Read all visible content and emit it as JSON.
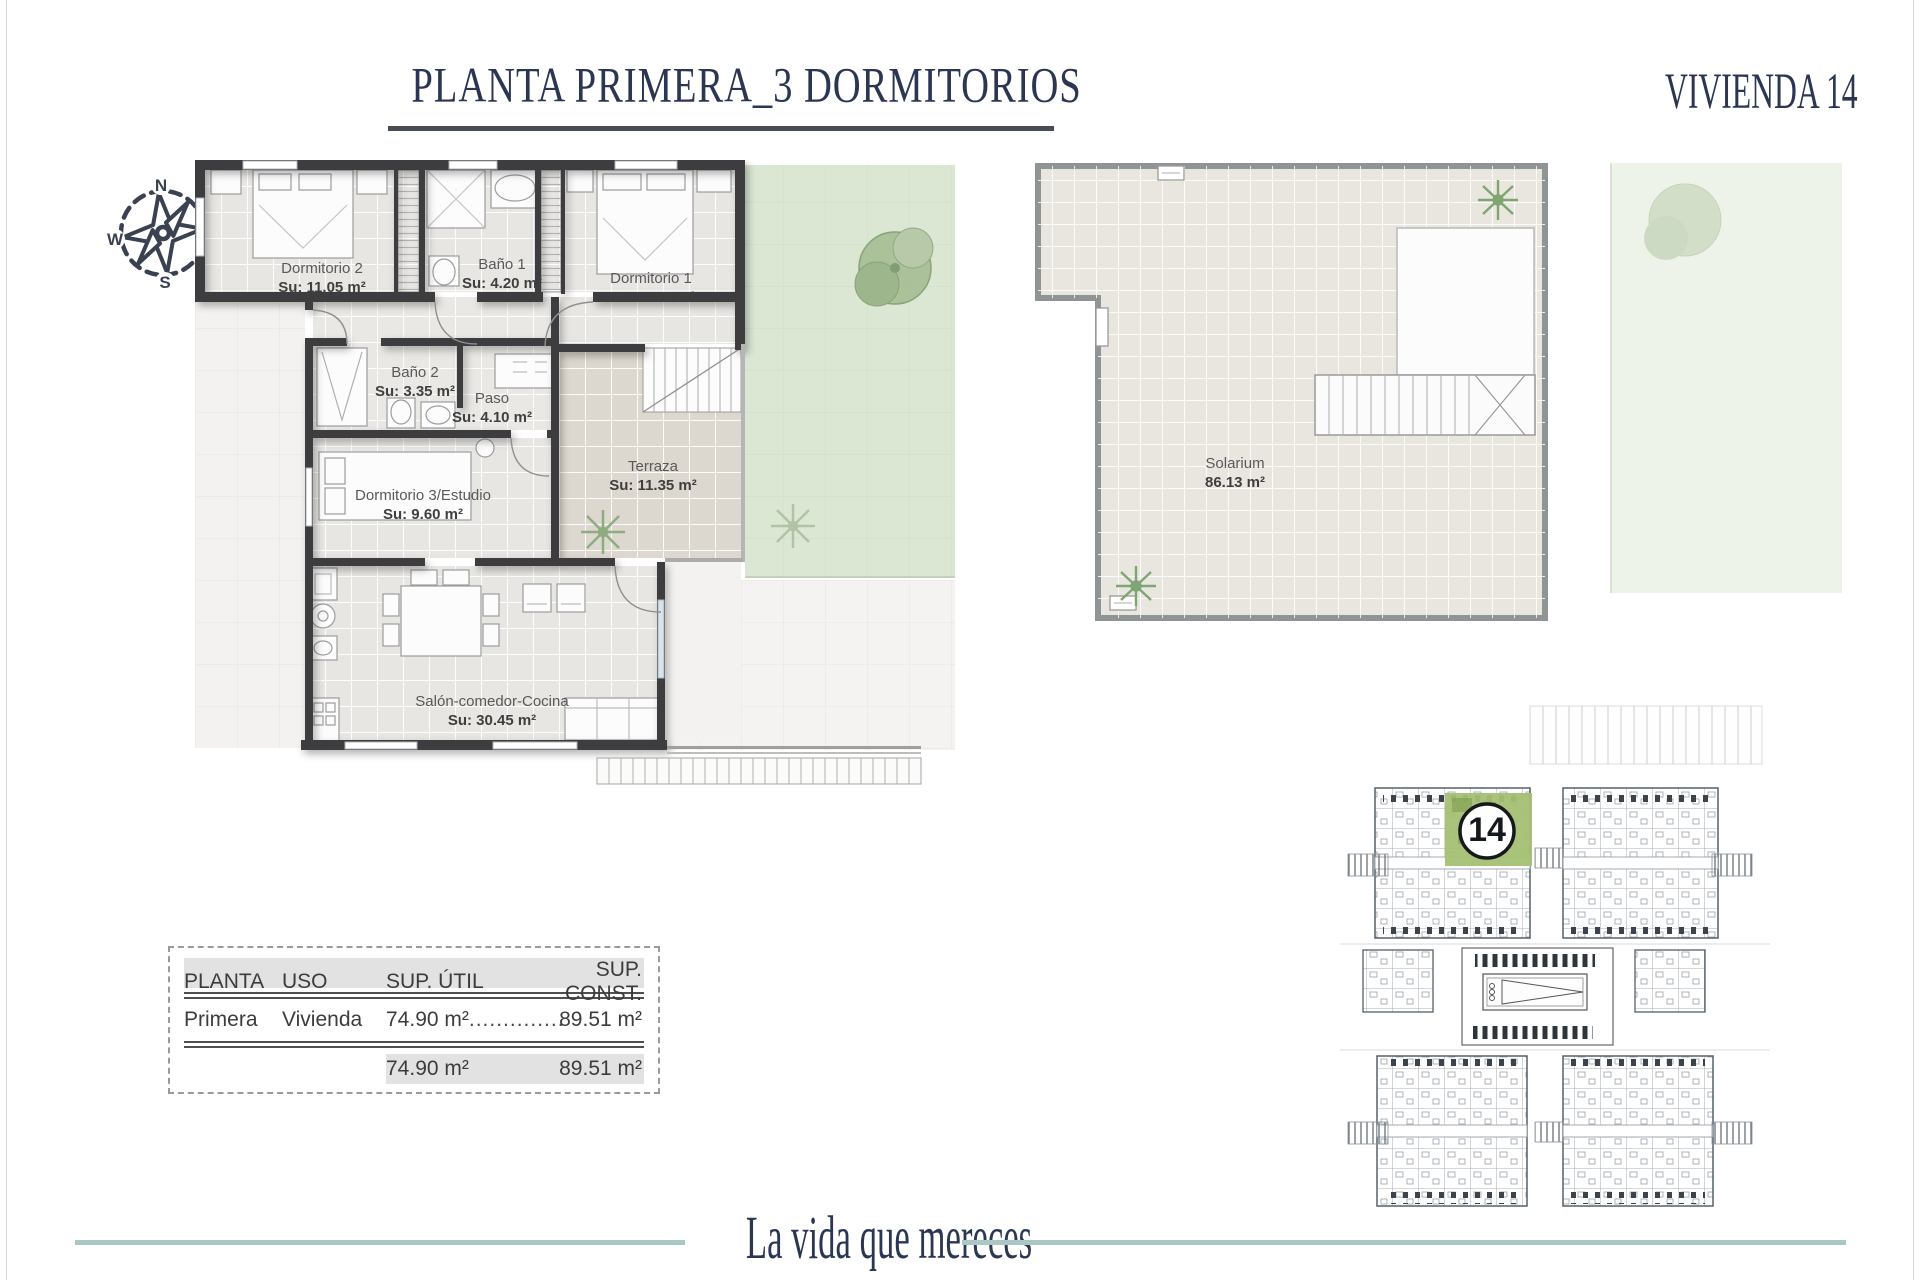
{
  "header": {
    "title": "PLANTA PRIMERA_3 DORMITORIOS",
    "unit": "VIVIENDA 14"
  },
  "compass": {
    "north": "N",
    "east": "E",
    "south": "S",
    "west": "W"
  },
  "floor_plan": {
    "rooms": [
      {
        "name": "Dormitorio 2",
        "area": "Su: 11.05 m²"
      },
      {
        "name": "Baño 1",
        "area": "Su: 4.20 m²"
      },
      {
        "name": "Dormitorio 1",
        "area": "Su: 12.15 m²"
      },
      {
        "name": "Baño 2",
        "area": "Su:  3.35 m²"
      },
      {
        "name": "Paso",
        "area": "Su: 4.10 m²"
      },
      {
        "name": "Dormitorio 3/Estudio",
        "area": "Su: 9.60 m²"
      },
      {
        "name": "Terraza",
        "area": "Su: 11.35 m²"
      },
      {
        "name": "Salón-comedor-Cocina",
        "area": "Su: 30.45 m²"
      }
    ]
  },
  "solarium": {
    "name": "Solarium",
    "area": "86.13 m²"
  },
  "site_plan": {
    "unit_badge": "14"
  },
  "areas_table": {
    "headers": [
      "PLANTA",
      "USO",
      "SUP. ÚTIL",
      "SUP. CONST."
    ],
    "row": {
      "planta": "Primera",
      "uso": "Vivienda",
      "sup_util": "74.90 m²",
      "dots": "..............",
      "sup_const": "89.51 m²"
    },
    "totals": {
      "sup_util": "74.90 m²",
      "sup_const": "89.51 m²"
    }
  },
  "footer": {
    "tagline": "La vida que mereces"
  },
  "colors": {
    "navy": "#2b3752",
    "teal_line": "#a9c8c5",
    "wall": "#3e3e40",
    "garden_green": "#dbe7d3",
    "highlight_green": "#a4c073",
    "floor_tile": "#e8e6e3"
  }
}
